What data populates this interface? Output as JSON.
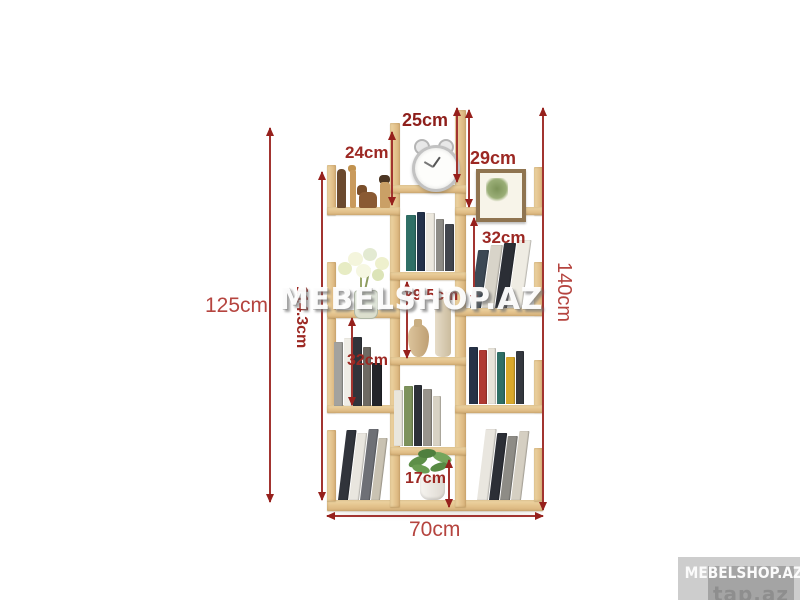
{
  "product": {
    "type_label": "tree-bookshelf-dimension-diagram"
  },
  "dimensions": {
    "height_left": "125cm",
    "height_inner": "114.3cm",
    "height_right": "140cm",
    "top_left_shelf": "24cm",
    "top_center_shelf": "25cm",
    "top_right_shelf": "29cm",
    "right_shelf": "32cm",
    "center_shelf": "29.5cm",
    "left_shelf": "32cm",
    "bottom_center_shelf": "17cm",
    "overall_width": "70cm"
  },
  "watermarks": {
    "center": "MEBELSHOP.AZ",
    "corner": "MEBELSHOP.AZ",
    "corner_site": "tap.az"
  },
  "colors": {
    "arrow": "#a23430",
    "label_small": "#9c2823",
    "label_big": "#b5443f",
    "wood": "#e3c28c"
  }
}
